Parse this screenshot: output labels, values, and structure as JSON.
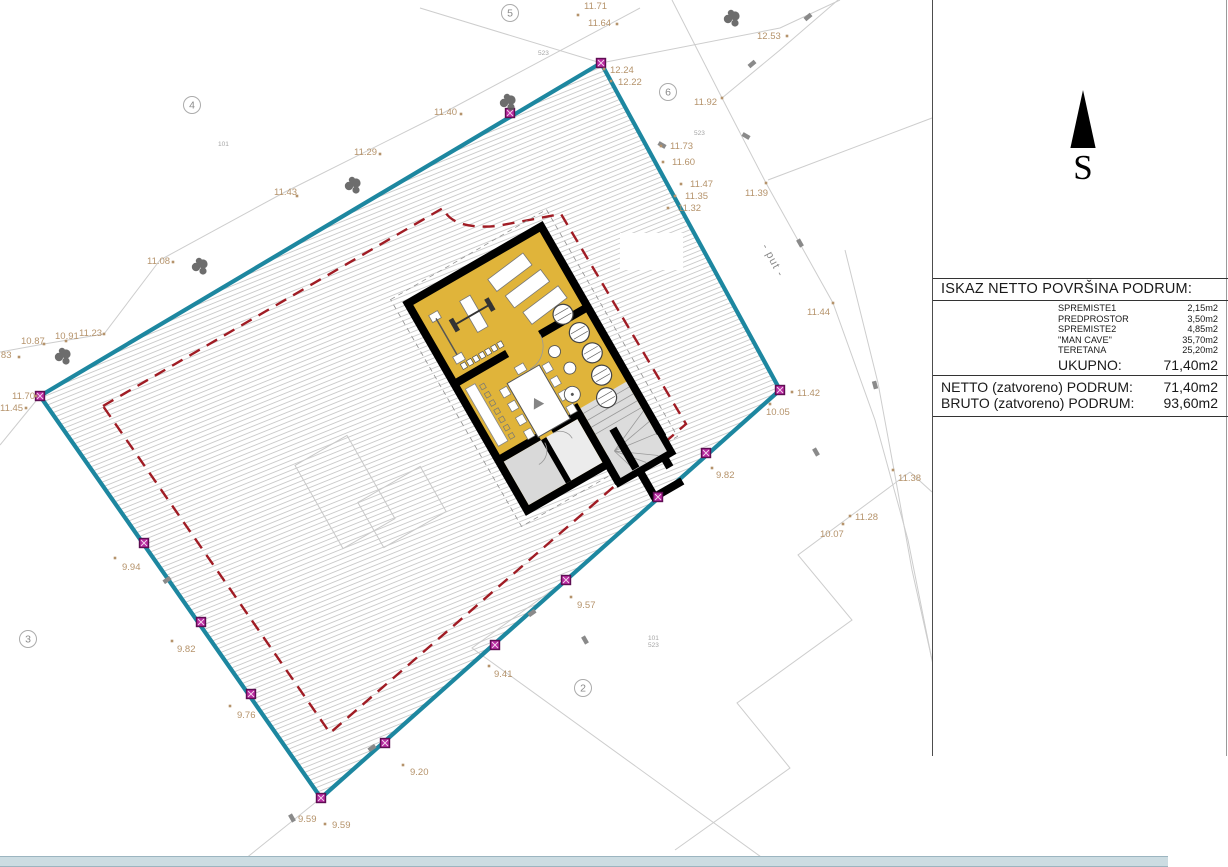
{
  "panel": {
    "north_label": "S",
    "table": {
      "title": "ISKAZ NETTO POVRŠINA PODRUM:",
      "rows": [
        {
          "label": "SPREMISTE1",
          "value": "2,15m2"
        },
        {
          "label": "PREDPROSTOR",
          "value": "3,50m2"
        },
        {
          "label": "SPREMISTE2",
          "value": "4,85m2"
        },
        {
          "label": "\"MAN CAVE\"",
          "value": "35,70m2"
        },
        {
          "label": "TERETANA",
          "value": "25,20m2"
        }
      ],
      "total": {
        "label": "UKUPNO:",
        "value": "71,40m2"
      },
      "summary": [
        {
          "label": "NETTO (zatvoreno) PODRUM:",
          "value": "71,40m2"
        },
        {
          "label": "BRUTO (zatvoreno) PODRUM:",
          "value": "93,60m2"
        }
      ]
    }
  },
  "drawing": {
    "road_label": "- put -",
    "colors": {
      "parcel_boundary": "#1d87a0",
      "setback_line": "#a01c24",
      "building_fill": "#e0b43a",
      "elevation_text": "#b5936b",
      "corner_marker": "#b82aa0",
      "bottom_band": "#ccdce2"
    },
    "elevation_points": [
      {
        "t": "11.71",
        "x": 584,
        "y": 9,
        "dx": 578,
        "dy": 15
      },
      {
        "t": "11.64",
        "x": 588,
        "y": 26,
        "dx": 617,
        "dy": 24
      },
      {
        "t": "12.24",
        "x": 610,
        "y": 73,
        "dx": 604,
        "dy": 69
      },
      {
        "t": "12.22",
        "x": 618,
        "y": 85,
        "dx": 611,
        "dy": 81
      },
      {
        "t": "12.53",
        "x": 757,
        "y": 39,
        "dx": 787,
        "dy": 36
      },
      {
        "t": "11.92",
        "x": 694,
        "y": 105,
        "dx": 722,
        "dy": 98
      },
      {
        "t": "11.40",
        "x": 434,
        "y": 115,
        "dx": 461,
        "dy": 114
      },
      {
        "t": "11.29",
        "x": 354,
        "y": 155,
        "dx": 380,
        "dy": 154
      },
      {
        "t": "11.43",
        "x": 274,
        "y": 195,
        "dx": 297,
        "dy": 196
      },
      {
        "t": "11.08",
        "x": 147,
        "y": 264,
        "dx": 173,
        "dy": 262
      },
      {
        "t": "11.73",
        "x": 670,
        "y": 149,
        "dx": 661,
        "dy": 146
      },
      {
        "t": "11.60",
        "x": 672,
        "y": 165,
        "dx": 663,
        "dy": 162
      },
      {
        "t": "11.47",
        "x": 690,
        "y": 187,
        "dx": 681,
        "dy": 184
      },
      {
        "t": "11.35",
        "x": 685,
        "y": 199,
        "dx": 675,
        "dy": 196
      },
      {
        "t": "11.32",
        "x": 678,
        "y": 211,
        "dx": 668,
        "dy": 208
      },
      {
        "t": "11.39",
        "x": 745,
        "y": 196,
        "dx": 766,
        "dy": 183
      },
      {
        "t": "11.44",
        "x": 807,
        "y": 315,
        "dx": 833,
        "dy": 303
      },
      {
        "t": "11.42",
        "x": 797,
        "y": 396,
        "dx": 792,
        "dy": 392
      },
      {
        "t": "10.05",
        "x": 766,
        "y": 415,
        "dx": 770,
        "dy": 404
      },
      {
        "t": "9.82",
        "x": 716,
        "y": 478,
        "dx": 712,
        "dy": 468
      },
      {
        "t": "11.38",
        "x": 898,
        "y": 481,
        "dx": 893,
        "dy": 470
      },
      {
        "t": "11.28",
        "x": 855,
        "y": 520,
        "dx": 850,
        "dy": 516
      },
      {
        "t": "10.07",
        "x": 820,
        "y": 537,
        "dx": 843,
        "dy": 524
      },
      {
        "t": "10.91",
        "x": 55,
        "y": 339,
        "dx": 66,
        "dy": 341
      },
      {
        "t": "10.87",
        "x": 21,
        "y": 344,
        "dx": 44,
        "dy": 344
      },
      {
        "t": "11.23",
        "x": 79,
        "y": 336,
        "dx": 104,
        "dy": 334
      },
      {
        "t": "0.83",
        "x": -7,
        "y": 358,
        "dx": 19,
        "dy": 357
      },
      {
        "t": "11.70",
        "x": 12,
        "y": 399,
        "dx": 36,
        "dy": 396
      },
      {
        "t": "11.45",
        "x": 0,
        "y": 411,
        "dx": 26,
        "dy": 408
      },
      {
        "t": "9.94",
        "x": 122,
        "y": 570,
        "dx": 115,
        "dy": 558
      },
      {
        "t": "9.82",
        "x": 177,
        "y": 652,
        "dx": 172,
        "dy": 641
      },
      {
        "t": "9.76",
        "x": 237,
        "y": 718,
        "dx": 230,
        "dy": 706
      },
      {
        "t": "9.20",
        "x": 410,
        "y": 775,
        "dx": 403,
        "dy": 765
      },
      {
        "t": "9.59",
        "x": 298,
        "y": 822
      },
      {
        "t": "9.59",
        "x": 332,
        "y": 828,
        "dx": 325,
        "dy": 824
      },
      {
        "t": "9.41",
        "x": 494,
        "y": 677,
        "dx": 489,
        "dy": 666
      },
      {
        "t": "9.57",
        "x": 577,
        "y": 608,
        "dx": 571,
        "dy": 597
      }
    ],
    "parcel_numbers": [
      {
        "t": "523",
        "x": 538,
        "y": 55
      },
      {
        "t": "523",
        "x": 694,
        "y": 135
      },
      {
        "t": "101",
        "x": 218,
        "y": 146
      },
      {
        "t": "101",
        "x": 648,
        "y": 640
      },
      {
        "t": "523",
        "x": 648,
        "y": 647
      }
    ],
    "circled_numbers": [
      {
        "t": "4",
        "x": 192,
        "y": 105
      },
      {
        "t": "5",
        "x": 510,
        "y": 13
      },
      {
        "t": "6",
        "x": 668,
        "y": 92
      },
      {
        "t": "3",
        "x": 28,
        "y": 639
      },
      {
        "t": "2",
        "x": 583,
        "y": 688
      }
    ],
    "trees": [
      [
        508,
        103
      ],
      [
        732,
        19
      ],
      [
        353,
        186
      ],
      [
        200,
        267
      ],
      [
        63,
        357
      ]
    ],
    "corner_markers": [
      [
        601,
        63
      ],
      [
        510,
        113
      ],
      [
        40,
        396
      ],
      [
        780,
        390
      ],
      [
        706,
        453
      ],
      [
        566,
        580
      ],
      [
        495,
        645
      ],
      [
        385,
        743
      ],
      [
        321,
        798
      ],
      [
        251,
        694
      ],
      [
        201,
        622
      ],
      [
        144,
        543
      ],
      [
        658,
        497
      ]
    ],
    "stakes": [
      [
        662,
        145,
        30
      ],
      [
        746,
        136,
        30
      ],
      [
        800,
        243,
        60
      ],
      [
        875,
        385,
        75
      ],
      [
        816,
        452,
        60
      ],
      [
        532,
        613,
        -35
      ],
      [
        808,
        17,
        -40
      ],
      [
        752,
        64,
        -40
      ],
      [
        292,
        818,
        60
      ],
      [
        167,
        580,
        -35
      ],
      [
        372,
        748,
        -35
      ],
      [
        585,
        640,
        60
      ]
    ]
  }
}
